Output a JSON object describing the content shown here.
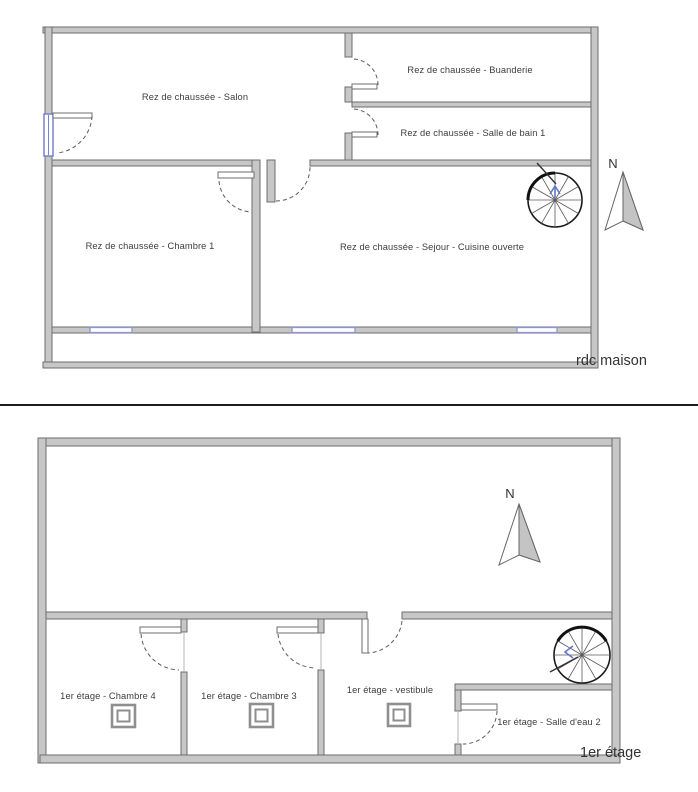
{
  "page": {
    "background": "#ffffff"
  },
  "colors": {
    "wall_fill": "#c7c7c7",
    "wall_outline": "#6e6e6e",
    "window_blue": "#8d93d8",
    "entry_door_blue": "#7b82cf",
    "stair_arrow_blue": "#5f79c8",
    "north_arrow_fill": "#c4c4c4",
    "divider": "#1c1c1c",
    "label_text": "#3d3d3d"
  },
  "plans": [
    {
      "id": "rdc",
      "floor_label": "rdc maison",
      "north": "N",
      "rooms": [
        {
          "label": "Rez de chaussée - Salon"
        },
        {
          "label": "Rez de chaussée - Buanderie"
        },
        {
          "label": "Rez de chaussée - Salle de bain 1"
        },
        {
          "label": "Rez de chaussée - Chambre 1"
        },
        {
          "label": "Rez de chaussée - Sejour - Cuisine ouverte"
        }
      ]
    },
    {
      "id": "etage1",
      "floor_label": "1er étage",
      "north": "N",
      "rooms": [
        {
          "label": "1er étage - Chambre 4"
        },
        {
          "label": "1er étage - Chambre 3"
        },
        {
          "label": "1er étage - vestibule"
        },
        {
          "label": "1er étage - Salle d'eau 2"
        }
      ]
    }
  ]
}
